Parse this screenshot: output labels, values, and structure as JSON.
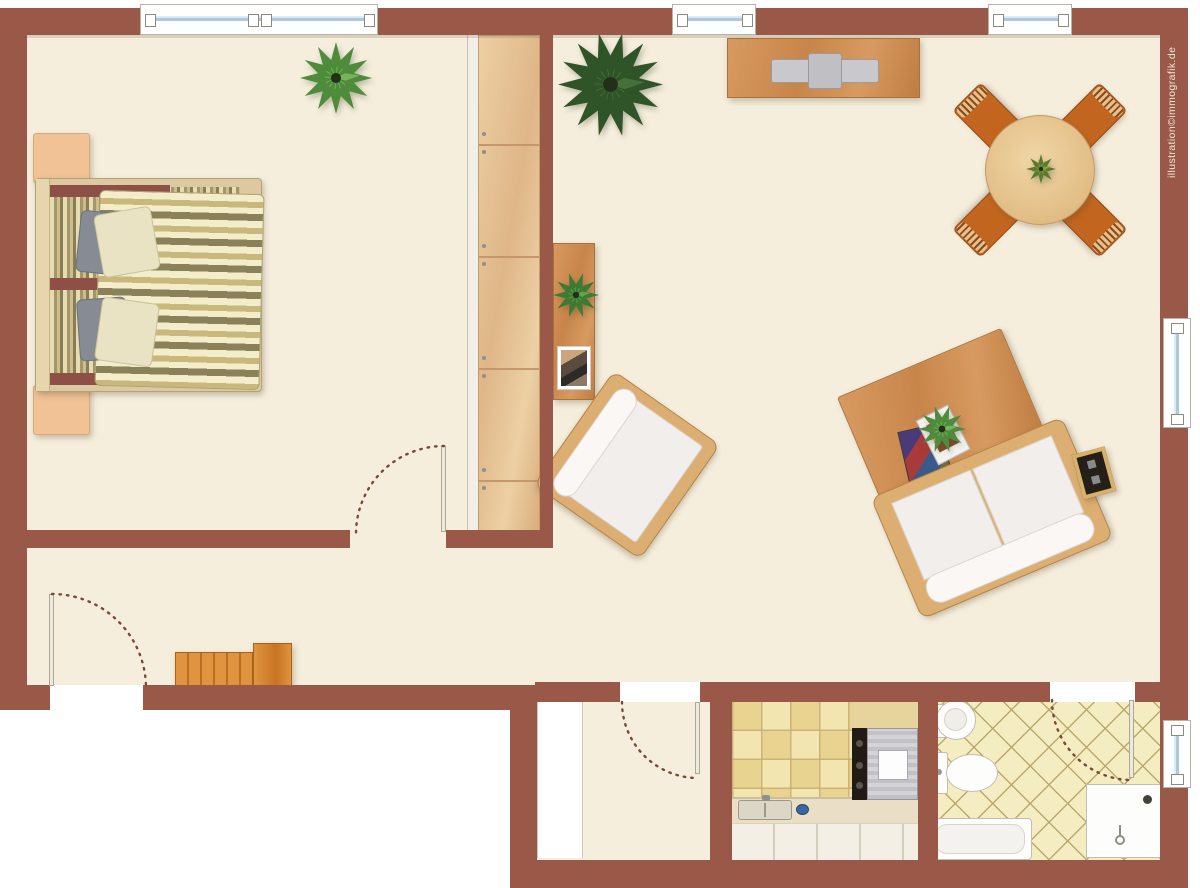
{
  "watermark": {
    "text": "illustration©immografik.de"
  },
  "palette": {
    "wall": "#9a5849",
    "floor": "#f5eedc",
    "exterior": "#ffffff",
    "wood_light": "#e8c79a",
    "wood_medium": "#cf9055",
    "accent_orange": "#c2661f",
    "window_glass": "#aac8de",
    "door_arc": "#7a4837",
    "kitchen_tile_a": "#f3e5b0",
    "kitchen_tile_b": "#e9d391",
    "bath_tile": "#f5edc2",
    "bath_grout": "#b9a96d",
    "fixture_white": "#fdfdfb",
    "sofa_white": "#f2eeec",
    "duvet_cream": "#f3edcb",
    "duvet_tan": "#c9b87b",
    "duvet_olive": "#8b8158",
    "bed_maroon": "#8e4f46",
    "plant_bright": "#4e8b3a",
    "plant_dark": "#2f5428"
  },
  "objects": {
    "furniture": [
      "double-bed",
      "nightstand",
      "wardrobe",
      "potted-plant",
      "sideboard",
      "tv",
      "dining-table",
      "dining-chair",
      "console-table",
      "armchair",
      "coffee-table",
      "sofa",
      "side-table",
      "hallway-dresser",
      "kitchen-counter",
      "sink",
      "cooktop",
      "oven",
      "washbasin",
      "toilet",
      "bathtub",
      "shower"
    ],
    "openings": [
      "entrance-door",
      "bedroom-door",
      "vestibule-door",
      "bathroom-door",
      "window"
    ]
  }
}
